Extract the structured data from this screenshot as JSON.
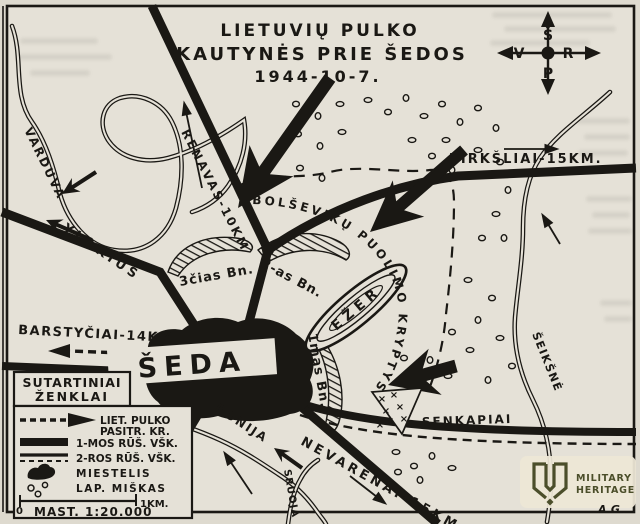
{
  "title": {
    "line1": "LIETUVIŲ PULKO",
    "line2": "KAUTYNĖS PRIE ŠEDOS",
    "line3": "1944-10-7."
  },
  "compass": {
    "north": "Š",
    "south": "P",
    "west": "V",
    "east": "R"
  },
  "places": {
    "town": "ŠEDA",
    "lake": "EŽER",
    "cemetery": "SENKAPIAI"
  },
  "roads": {
    "renavas": "RENAVAS-10KM",
    "tirksliai": "TIRKŠLIAI-15KM.",
    "barstyciai": "BARSTYČIAI-14KM.",
    "nevarenai": "NEVARĖNAI-15KM",
    "ylakius": "YLAKIUS"
  },
  "rivers": {
    "varduva": "VARDUVA",
    "donija": "DONIJA",
    "sruoja": "SRUOJA",
    "seiksne": "ŠEIKŠNĖ"
  },
  "units": {
    "bn1": "1mas Bn.",
    "bn2": "2-as Bn.",
    "bn3": "3čias Bn."
  },
  "enemy": {
    "attack_label": "BOLŠEVIKŲ PUOLIMO KRYPTYS"
  },
  "legend": {
    "title_line1": "SUTARTINIAI",
    "title_line2": "ŽENKLAI",
    "items": [
      {
        "label_line1": "LIET. PULKO",
        "label_line2": "PASITR. KR."
      },
      {
        "label": "1-MOS RŪŠ. VŠK."
      },
      {
        "label": "2-ROS RŪŠ. VŠK."
      },
      {
        "label": "MIESTELIS"
      },
      {
        "label": "LAP. MIŠKAS"
      }
    ],
    "scale": {
      "zero": "0",
      "km": "1KM.",
      "text": "MAST. 1:20.000"
    }
  },
  "watermark": {
    "line1": "MILITARY",
    "line2": "HERITAGE",
    "color": "#4b4e2a"
  },
  "signature": "A.G.",
  "colors": {
    "paper": "#e5e1d7",
    "ink": "#1a1814"
  }
}
